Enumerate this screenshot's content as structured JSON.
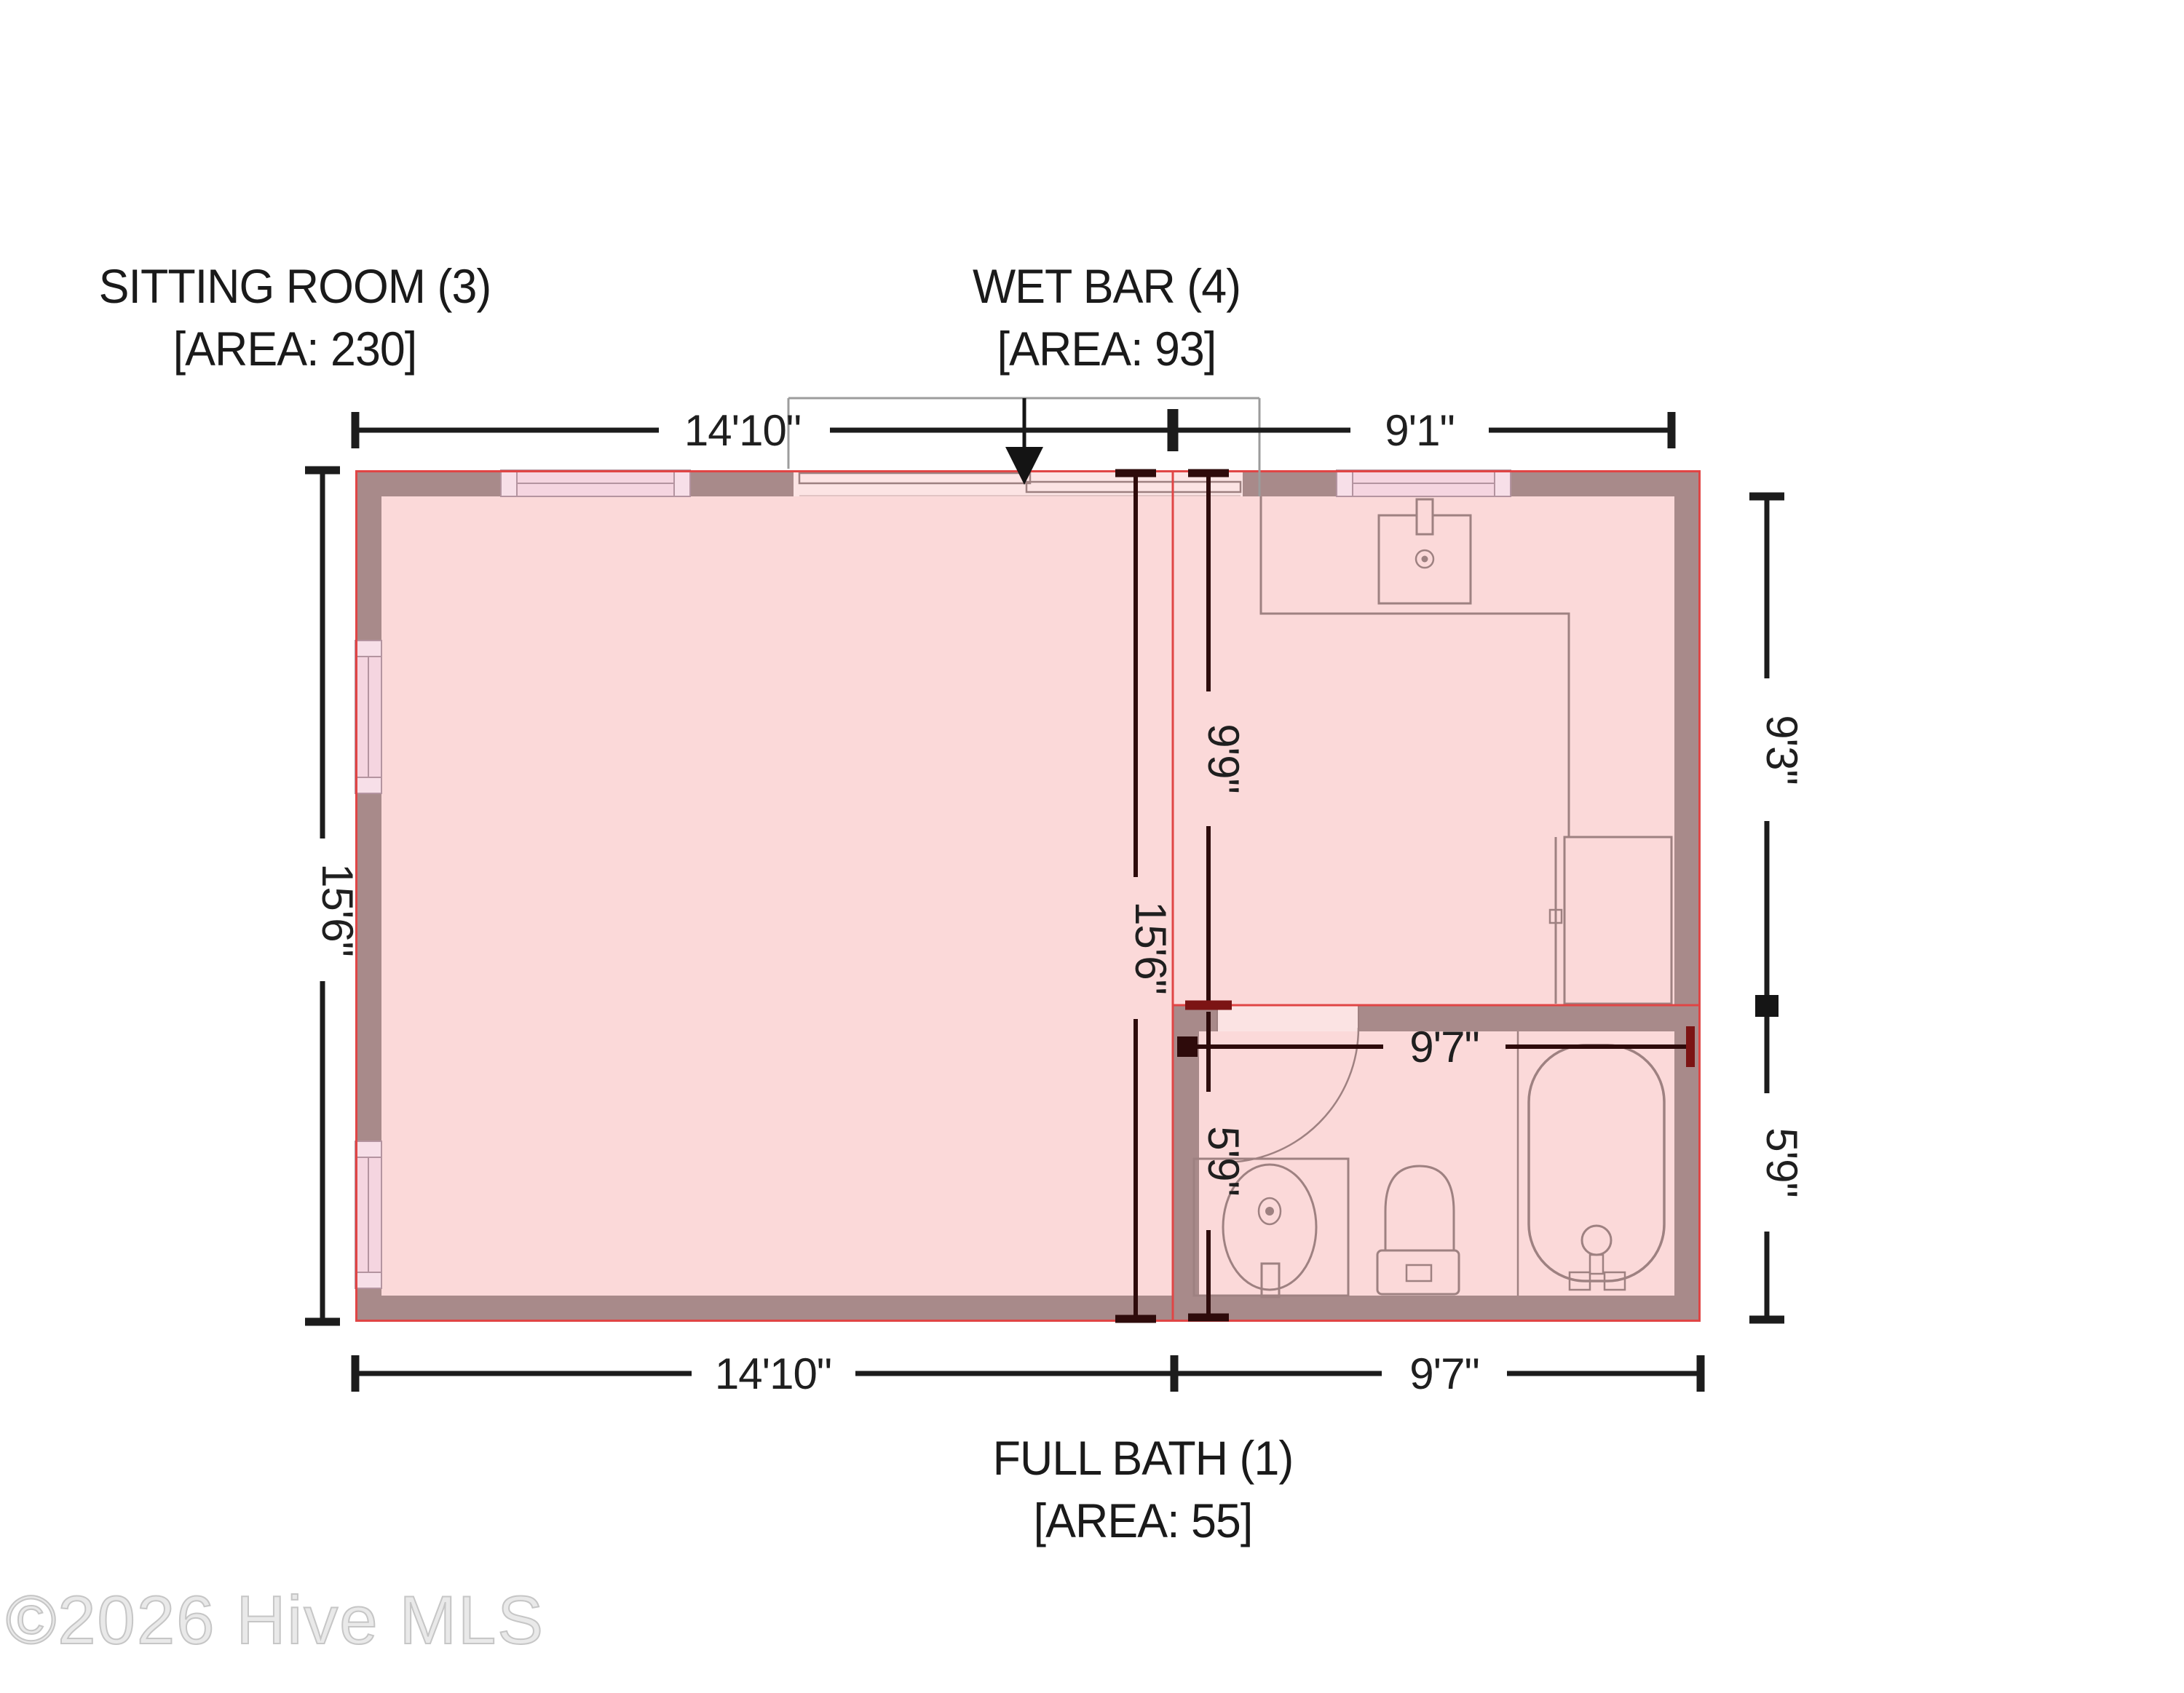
{
  "rooms": {
    "sitting_room": {
      "name": "SITTING ROOM (3)",
      "area": "[AREA: 230]"
    },
    "wet_bar": {
      "name": "WET BAR (4)",
      "area": "[AREA: 93]"
    },
    "full_bath": {
      "name": "FULL BATH (1)",
      "area": "[AREA: 55]"
    }
  },
  "dimensions": {
    "top_sitting_width": "14'10\"",
    "top_wetbar_width": "9'1\"",
    "left_height": "15'6\"",
    "interior_height": "15'6\"",
    "wetbar_height": "9'9\"",
    "bath_interior_height": "5'9\"",
    "right_wetbar_height": "9'3\"",
    "right_bath_height": "5'9\"",
    "bath_interior_width": "9'7\"",
    "bottom_sitting_width": "14'10\"",
    "bottom_bath_width": "9'7\""
  },
  "watermark": "©2026 Hive MLS",
  "colors": {
    "floor": "#fbd9d9",
    "wall": "#a88a8a",
    "room_outline_red": "#e04545",
    "window_fill": "#f5d5e0",
    "window_cap_fill": "#f7dfe8",
    "fixture_outline": "#9e8181",
    "dimension_black": "#1c1c1c",
    "dimension_maroon": "#2e0b0b",
    "dimension_dark_red": "#7c1414",
    "guide_gray": "#9c9c9c"
  }
}
